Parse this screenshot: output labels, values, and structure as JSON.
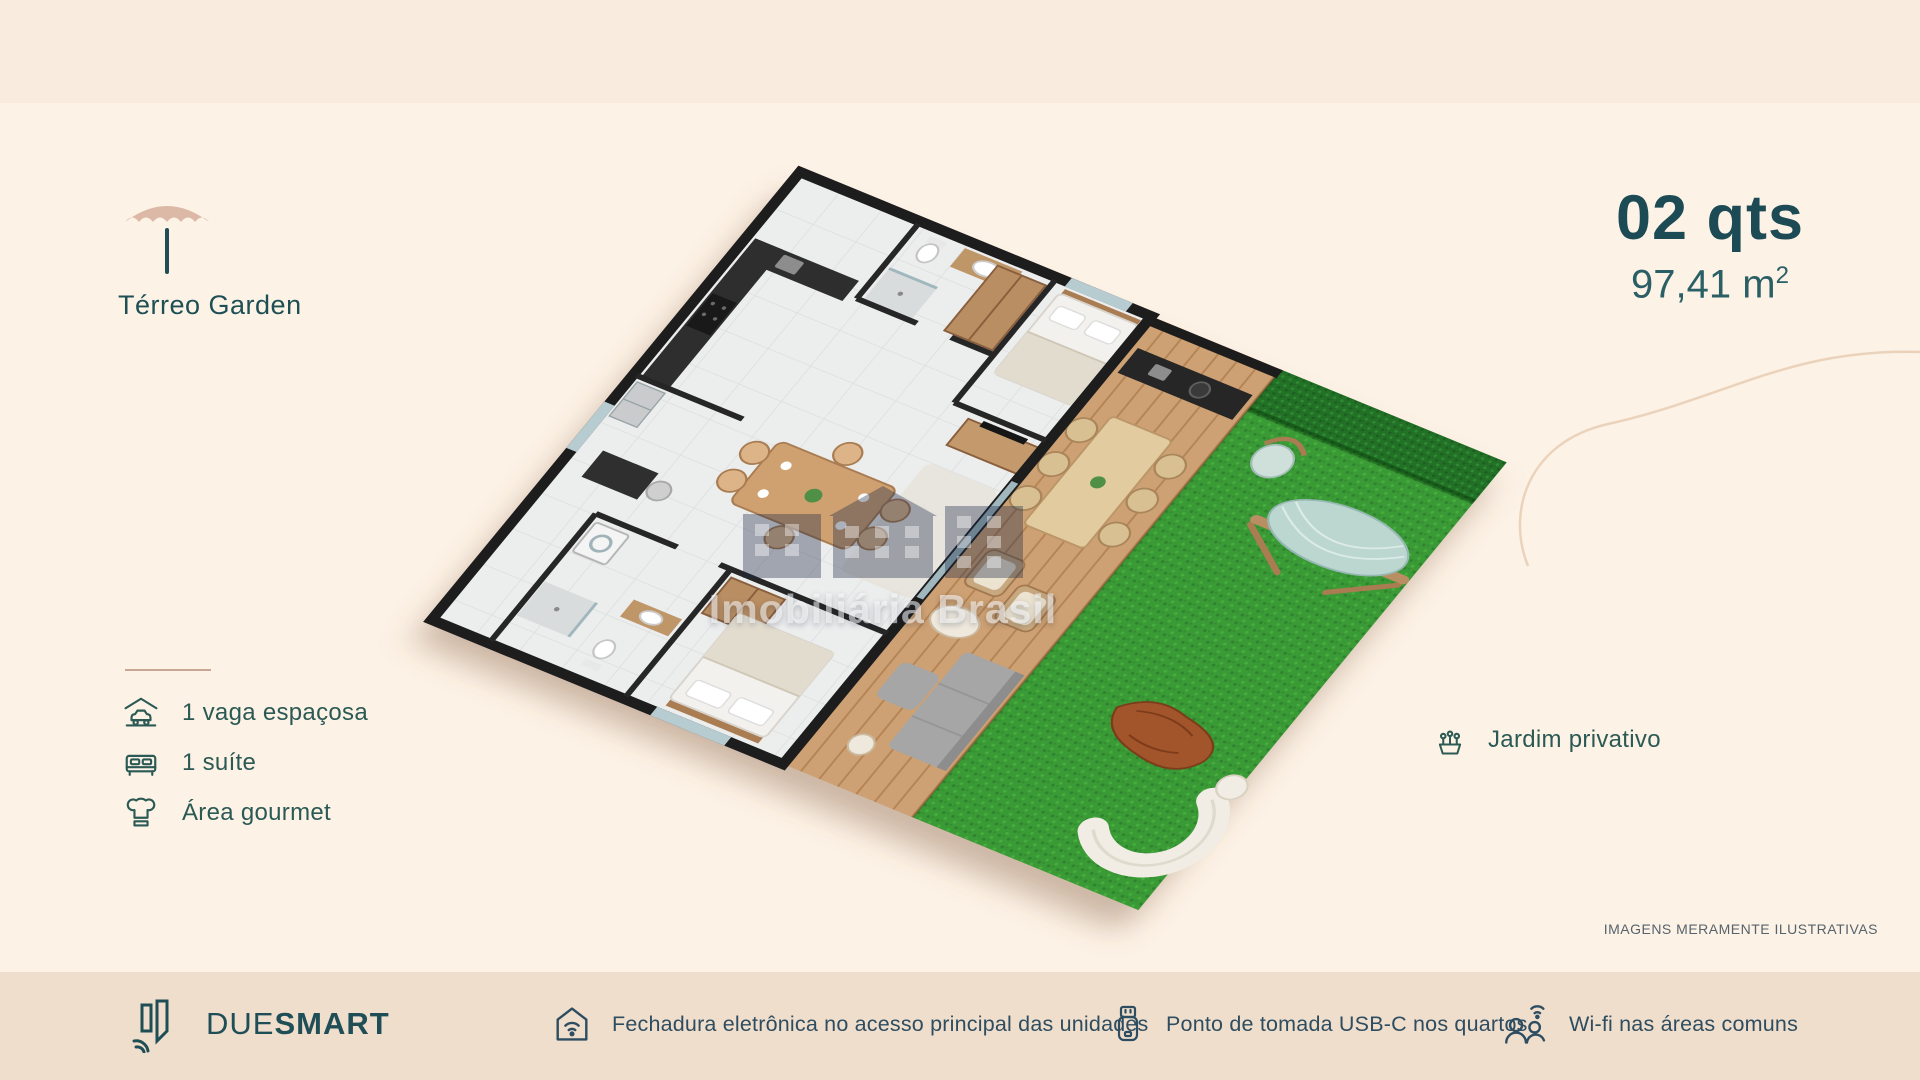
{
  "palette": {
    "background": "#fdf2e6",
    "top_band": "#f9ebdd",
    "footer_bar": "#f0decd",
    "accent_teal": "#1f4e57",
    "feature_text": "#2b5a55",
    "footer_text": "#2e4d60",
    "umbrella_canopy": "#dcb9a7",
    "grass_green": "#3a9a35",
    "deck_wood": "#cda173"
  },
  "header": {
    "icon": "umbrella-icon",
    "plan_label": "Térreo Garden"
  },
  "specs": {
    "bedrooms": "02 qts",
    "area_value": "97,41 m",
    "area_sup": "2"
  },
  "features": [
    {
      "icon": "carport-icon",
      "label": "1 vaga espaçosa"
    },
    {
      "icon": "bed-icon",
      "label": "1 suíte"
    },
    {
      "icon": "chef-hat-icon",
      "label": "Área gourmet"
    }
  ],
  "garden_callout": {
    "icon": "planter-icon",
    "label": "Jardim privativo"
  },
  "watermark": {
    "logo": "imobiliaria-brasil-logo",
    "text": "Imobiliária Brasil"
  },
  "disclaimer": "IMAGENS MERAMENTE ILUSTRATIVAS",
  "footer": {
    "brand": {
      "icon": "duesmart-logo-icon",
      "name_light": "DUE",
      "name_bold": "SMART"
    },
    "items": [
      {
        "icon": "smart-lock-icon",
        "label": "Fechadura eletrônica no acesso principal das unidades"
      },
      {
        "icon": "usb-icon",
        "label": "Ponto de tomada USB-C nos quartos"
      },
      {
        "icon": "wifi-people-icon",
        "label": "Wi-fi nas áreas comuns"
      }
    ]
  }
}
